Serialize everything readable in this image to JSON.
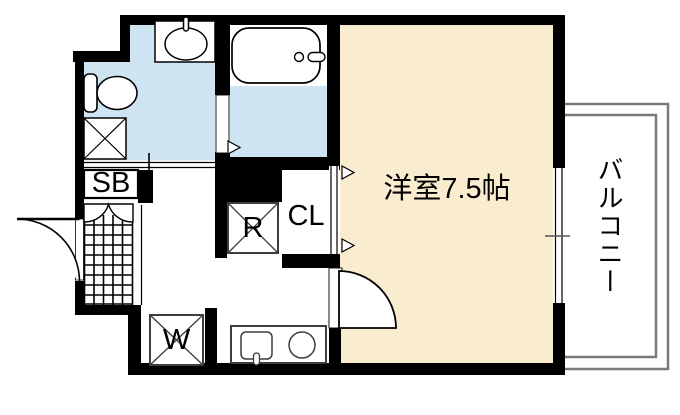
{
  "floorplan": {
    "type": "apartment-floor-plan",
    "labels": {
      "western_room": "洋室7.5帖",
      "balcony": "バルコニー",
      "shoe_box": "SB",
      "refrigerator": "R",
      "closet": "CL",
      "washing_machine": "W"
    },
    "icons": [
      "toilet-icon",
      "wash-basin-icon",
      "bathtub-icon",
      "kitchen-sink-icon",
      "stove-burner-icon",
      "washer-x-box-icon",
      "refrigerator-x-box-icon",
      "shaft-x-box-icon",
      "entrance-door-swing-icon",
      "room-door-swing-icon",
      "sliding-door-icon",
      "door-direction-triangle-icon",
      "window-icon",
      "genkan-tile-hatch",
      "shoe-box-double-door-arcs"
    ],
    "colors": {
      "wall": "#000000",
      "wet_area_floor": "#cfe4f3",
      "room_floor": "#faeccf",
      "balcony_outline": "#7a7a7a",
      "appliance_outline": "#3d3d3d"
    }
  }
}
